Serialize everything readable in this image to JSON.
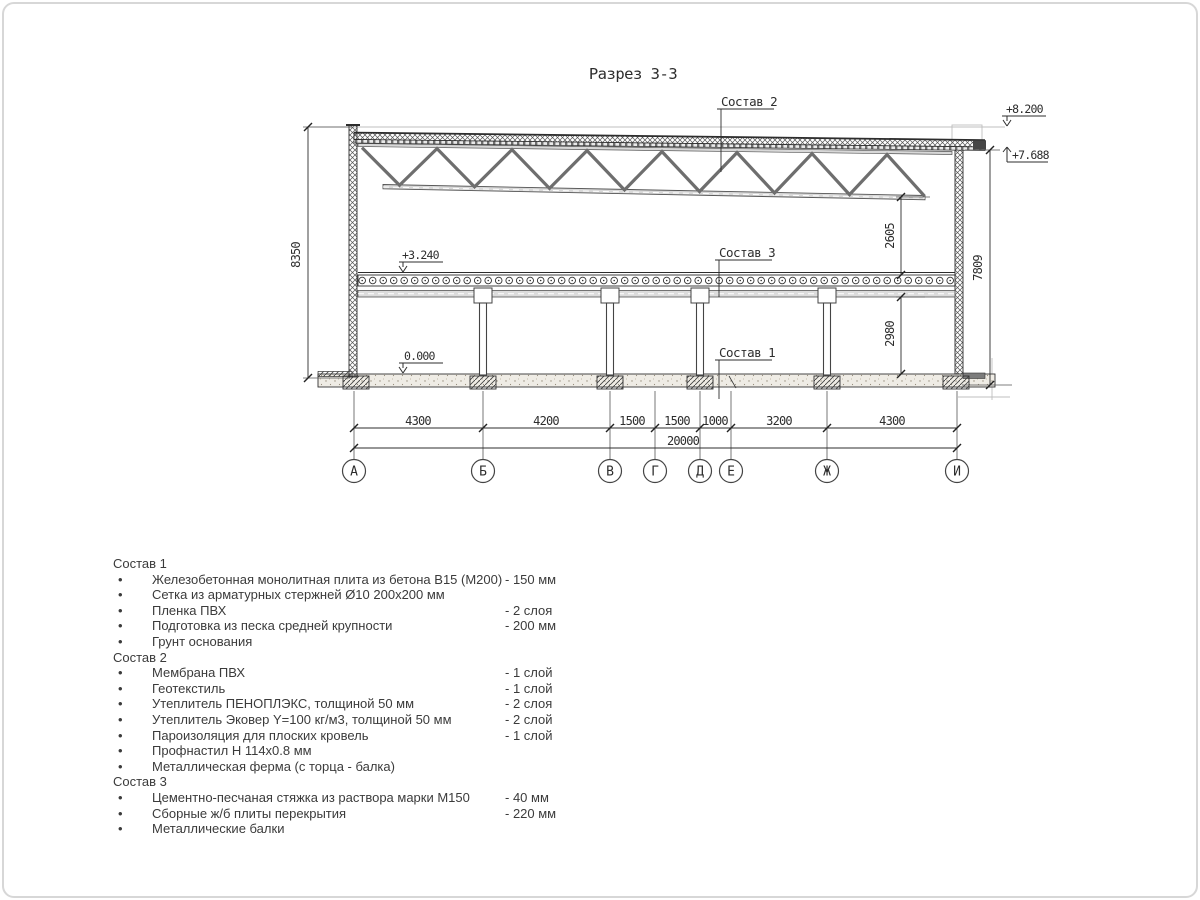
{
  "title": "Разрез 3-3",
  "drawing": {
    "callouts": {
      "c1": "Состав 1",
      "c2": "Состав 2",
      "c3": "Состав 3"
    },
    "elevations": {
      "roof_top": "+8.200",
      "roof_bearing": "+7.688",
      "floor": "+3.240",
      "ground": "0.000"
    },
    "dimensions": {
      "left_height": "8350",
      "upper_right": "2605",
      "lower_right": "2980",
      "right_total": "7809",
      "overall": "20000",
      "segments": [
        "4300",
        "4200",
        "1500",
        "1500",
        "1000",
        "3200",
        "4300"
      ]
    },
    "axes": [
      "А",
      "Б",
      "В",
      "Г",
      "Д",
      "Е",
      "Ж",
      "И"
    ]
  },
  "legend": {
    "bullet": "•",
    "sections": [
      {
        "title": "Состав 1",
        "items": [
          {
            "name": "Железобетонная монолитная плита из бетона В15 (М200)",
            "qty": "-  150 мм"
          },
          {
            "name": "Сетка из арматурных стержней Ø10 200х200 мм",
            "qty": ""
          },
          {
            "name": "Пленка ПВХ",
            "qty": "-  2 слоя"
          },
          {
            "name": "Подготовка из песка средней крупности",
            "qty": "- 200 мм"
          },
          {
            "name": "Грунт основания",
            "qty": ""
          }
        ]
      },
      {
        "title": "Состав 2",
        "items": [
          {
            "name": "Мембрана ПВХ",
            "qty": "- 1 слой"
          },
          {
            "name": "Геотекстиль",
            "qty": "- 1 слой"
          },
          {
            "name": "Утеплитель ПЕНОПЛЭКС, толщиной 50 мм",
            "qty": "- 2 слоя"
          },
          {
            "name": "Утеплитель Эковер Y=100 кг/м3, толщиной 50 мм",
            "qty": "- 2 слой"
          },
          {
            "name": "Пароизоляция для плоских кровель",
            "qty": "- 1 слой"
          },
          {
            "name": "Профнастил Н 114х0.8 мм",
            "qty": ""
          },
          {
            "name": "Металлическая ферма (с торца - балка)",
            "qty": ""
          }
        ]
      },
      {
        "title": "Состав 3",
        "items": [
          {
            "name": "Цементно-песчаная стяжка из раствора марки М150",
            "qty": "-  40 мм"
          },
          {
            "name": "Сборные ж/б плиты перекрытия",
            "qty": "- 220 мм"
          },
          {
            "name": "Металлические балки",
            "qty": ""
          }
        ]
      }
    ]
  }
}
